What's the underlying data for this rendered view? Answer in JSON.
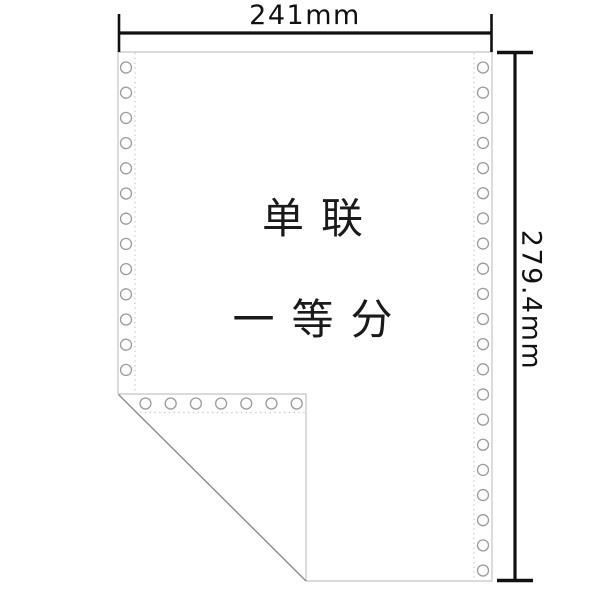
{
  "dimensions": {
    "width_label": "241mm",
    "height_label": "279.4mm"
  },
  "paper": {
    "label_line1": "单联",
    "label_line2": "一等分"
  },
  "colors": {
    "paper_edge": "#c4c4c4",
    "fold_edge": "#8c8c8c",
    "perforation_dots": "#c9c9c9",
    "hole_ring": "#9b9b9b",
    "hole_fill": "#ffffff",
    "dimension_line": "#111111",
    "label_text": "#1a1a1a",
    "background": "#ffffff"
  },
  "holes": {
    "radius": 5.5,
    "left_column": {
      "count": 13,
      "cx": 126,
      "start_y": 67.5,
      "step": 25.2
    },
    "right_column": {
      "count": 21,
      "cx": 483,
      "start_y": 67.5,
      "step": 25.15
    },
    "fold_row": {
      "count": 7,
      "cy": 403.5,
      "start_x": 145.5,
      "step": 25.2
    }
  }
}
